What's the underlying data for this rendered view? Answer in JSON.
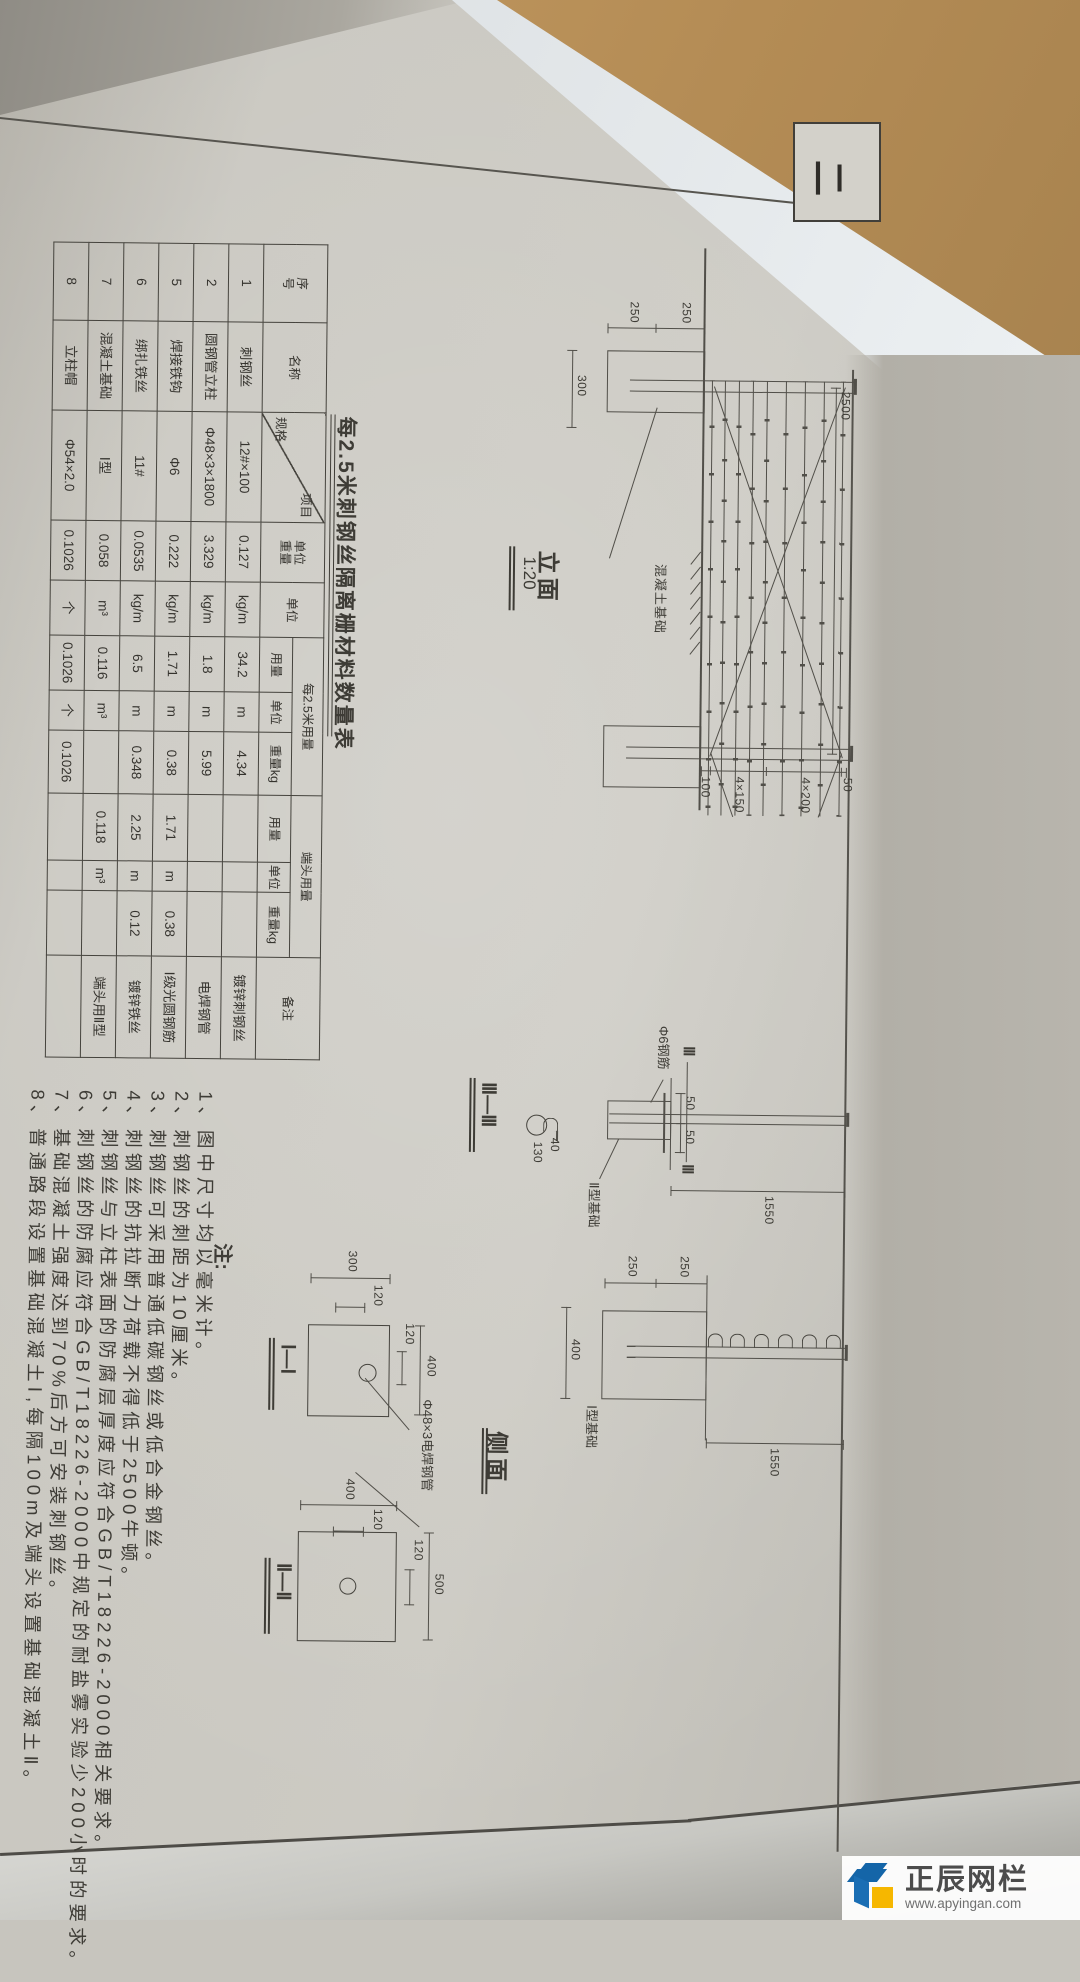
{
  "corner_tag": "二",
  "table": {
    "title": "每2.5米刺钢丝隔离栅材料数量表",
    "header": {
      "seq": "序号",
      "name": "名称",
      "item": "项目",
      "spec": "规格",
      "unit_weight": "单位重量",
      "unit": "单位",
      "per25": "每2.5米用量",
      "end": "端头用量",
      "qty": "用量",
      "weight_kg": "重量kg",
      "remark": "备注"
    },
    "rows": [
      {
        "no": "1",
        "name": "刺钢丝",
        "spec": "12#×100",
        "uw": "0.127",
        "uwu": "kg/m",
        "q1": "34.2",
        "u1": "m",
        "w1": "4.34",
        "q2": "",
        "u2": "",
        "w2": "",
        "remark": "镀锌刺钢丝"
      },
      {
        "no": "2",
        "name": "圆钢管立柱",
        "spec": "Φ48×3×1800",
        "uw": "3.329",
        "uwu": "kg/m",
        "q1": "1.8",
        "u1": "m",
        "w1": "5.99",
        "q2": "",
        "u2": "",
        "w2": "",
        "remark": "电焊钢管"
      },
      {
        "no": "5",
        "name": "焊接铁钩",
        "spec": "Φ6",
        "uw": "0.222",
        "uwu": "kg/m",
        "q1": "1.71",
        "u1": "m",
        "w1": "0.38",
        "q2": "1.71",
        "u2": "m",
        "w2": "0.38",
        "remark": "Ⅰ级光圆钢筋"
      },
      {
        "no": "6",
        "name": "绑扎铁丝",
        "spec": "11#",
        "uw": "0.0535",
        "uwu": "kg/m",
        "q1": "6.5",
        "u1": "m",
        "w1": "0.348",
        "q2": "2.25",
        "u2": "m",
        "w2": "0.12",
        "remark": "镀锌铁丝"
      },
      {
        "no": "7",
        "name": "混凝土基础",
        "spec": "Ⅰ型",
        "uw": "0.058",
        "uwu": "m³",
        "q1": "0.116",
        "u1": "m³",
        "w1": "",
        "q2": "0.118",
        "u2": "m³",
        "w2": "",
        "remark": "端头用Ⅱ型"
      },
      {
        "no": "8",
        "name": "立柱帽",
        "spec": "Φ54×2.0",
        "uw": "0.1026",
        "uwu": "个",
        "q1": "0.1026",
        "u1": "个",
        "w1": "0.1026",
        "q2": "",
        "u2": "",
        "w2": "",
        "remark": ""
      }
    ]
  },
  "elevation": {
    "title": "立面",
    "scale": "1:20",
    "foundation_label": "混凝土基础",
    "dims": {
      "span": "2500",
      "depth1": "250",
      "depth2": "250",
      "width": "300",
      "s50": "50",
      "s200": "4×200",
      "s150": "4×150",
      "s100": "100"
    }
  },
  "side": {
    "title": "侧面",
    "rebar_label": "Φ6钢筋",
    "pipe_label": "Φ48×3电焊钢管",
    "base2_label": "Ⅱ型基础",
    "base1_label": "Ⅰ型基础",
    "sec3_label": "Ⅲ—Ⅲ",
    "sec3_mark": "Ⅲ",
    "dims": {
      "h1": "1550",
      "h2": "1550",
      "a50a": "50",
      "a50b": "50",
      "a40": "40",
      "a130": "130",
      "b250a": "250",
      "b250b": "250",
      "b400": "400"
    },
    "sec1": {
      "label": "Ⅰ—Ⅰ",
      "w": "300",
      "wi": "120",
      "h": "400",
      "hi": "120"
    },
    "sec2": {
      "label": "Ⅱ—Ⅱ",
      "w": "400",
      "wi": "120",
      "h": "500",
      "hi": "120"
    }
  },
  "notes": {
    "heading": "注:",
    "items": [
      "1、图中尺寸均以毫米计。",
      "2、刺钢丝的刺距为10厘米。",
      "3、刺钢丝可采用普通低碳钢丝或低合金钢丝。",
      "4、刺钢丝的抗拉断力荷载不得低于2500牛顿。",
      "5、刺钢丝与立柱表面的防腐层厚度应符合GB/T18226-2000相关要求。",
      "6、刺钢丝的防腐应符合GB/T18226-2000中规定的耐盐雾实验少200小时的要求。",
      "7、基础混凝土强度达到70%后方可安装刺钢丝。",
      "8、普通路段设置基础混凝土Ⅰ,每隔100m及端头设置基础混凝土Ⅱ。"
    ]
  },
  "watermark": {
    "brand": "正辰网栏",
    "url": "www.apyingan.com"
  }
}
